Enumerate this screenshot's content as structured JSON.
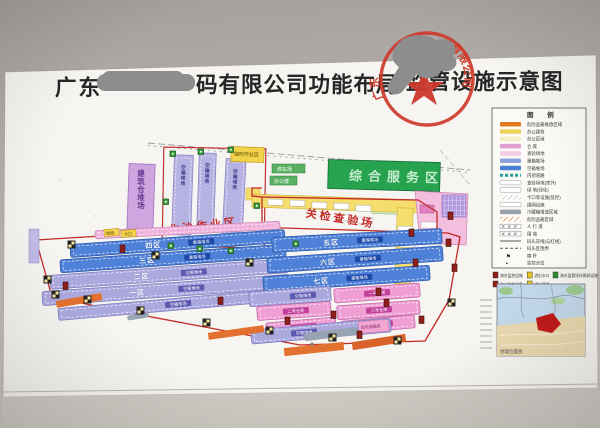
{
  "title": {
    "prefix": "广东",
    "middle": "码有限公司功能布局",
    "suffix": "监管设施示意图"
  },
  "stamp": {
    "ring_left": "广东",
    "ring_right": "有限公司",
    "color": "#c93a2c"
  },
  "legend": {
    "title": "图  例",
    "rows": [
      {
        "swatch": "orange",
        "label": "危险品箱堆放区域"
      },
      {
        "swatch": "yellow",
        "label": "办公建筑"
      },
      {
        "swatch": "paleyellow",
        "label": "办公区域"
      },
      {
        "swatch": "magenta",
        "label": "仓  库"
      },
      {
        "swatch": "pink",
        "label": "查验场地"
      },
      {
        "swatch": "periwinkle",
        "label": "重箱堆场"
      },
      {
        "swatch": "blue",
        "label": "空箱堆场"
      },
      {
        "swatch": "tealdash",
        "label": "内部道路"
      },
      {
        "swatch": "outline",
        "label": "查验场地(室外)"
      },
      {
        "swatch": "outline",
        "label": "绿 地(绿化)"
      },
      {
        "swatch": "hatch",
        "label": "卡口等设施(监控)"
      },
      {
        "swatch": "outline",
        "label": "围网设施"
      },
      {
        "swatch": "gray",
        "label": "冷藏箱堆放区域"
      },
      {
        "swatch": "orangehatch",
        "label": "危险品箱区域"
      },
      {
        "swatch": "track",
        "label": "人 行 道"
      },
      {
        "swatch": "track",
        "label": "围  墙"
      },
      {
        "swatch": "line",
        "label": "码头岸线(与红线)"
      },
      {
        "swatch": "dashline",
        "label": "码头区围界"
      },
      {
        "swatch": "flag",
        "label": "旗 杆"
      },
      {
        "swatch": "dot",
        "label": "监控点位"
      }
    ],
    "chips": [
      [
        {
          "color": "#8e1f1a",
          "label": "海关监控设施"
        },
        {
          "color": "#e6c428",
          "label": "进出卡口"
        },
        {
          "color": "#2f8f2f",
          "label": "海关监管场所围网设施"
        }
      ],
      [
        {
          "color": "#8e1f1a",
          "label": "海关监控设备"
        },
        {
          "color": "#e6c428",
          "label": "进出通道"
        }
      ]
    ],
    "flag_glyph": "⚑",
    "dot_glyph": "▪"
  },
  "map": {
    "beisha_area_label": "北沙作业区",
    "inspection_area_label": "关检查验场",
    "construction_yard_label": "建筑仓堆场",
    "service_area_label": "综合服务区",
    "temp_area_label": "临时作业区",
    "parking_label": "停车场",
    "office_label": "办公楼",
    "weighbridge_label": "地磅",
    "gate_label": "卡口",
    "dangerous_label": "危险品箱区",
    "vertical_yards": [
      {
        "zone": "一区",
        "badge": "空箱堆场"
      },
      {
        "zone": "二区",
        "badge": "空箱堆场"
      },
      {
        "zone": "三区",
        "badge": "空箱堆场"
      }
    ],
    "left_yards": [
      {
        "zone": "四区",
        "badge": "重箱堆场",
        "type": "blue"
      },
      {
        "zone": "三区",
        "badge": "重箱堆场",
        "type": "blue"
      },
      {
        "zone": "二区",
        "badge": "空箱堆场",
        "type": "lavender"
      },
      {
        "zone": "一区",
        "badge": "空箱堆场",
        "type": "lavender"
      },
      {
        "zone": "",
        "badge": "空箱堆场",
        "type": "lavender"
      }
    ],
    "right_yards": [
      {
        "zone": "五区",
        "badge": "重箱堆场",
        "type": "blue"
      },
      {
        "zone": "六区",
        "badge": "重箱堆场",
        "type": "blue"
      },
      {
        "zone": "七区",
        "badge": "重箱堆场",
        "type": "blue"
      },
      {
        "zone": "",
        "badge": "空箱堆场",
        "type": "lavender"
      }
    ],
    "warehouses": [
      {
        "label": "一号仓库"
      },
      {
        "label": "二号仓库"
      },
      {
        "label": "三号仓库"
      },
      {
        "label": "四号仓库"
      },
      {
        "label": "五号仓库"
      }
    ],
    "bottom_yard": {
      "badge": "空箱堆场"
    }
  },
  "inset": {
    "caption": "地理位置图"
  }
}
